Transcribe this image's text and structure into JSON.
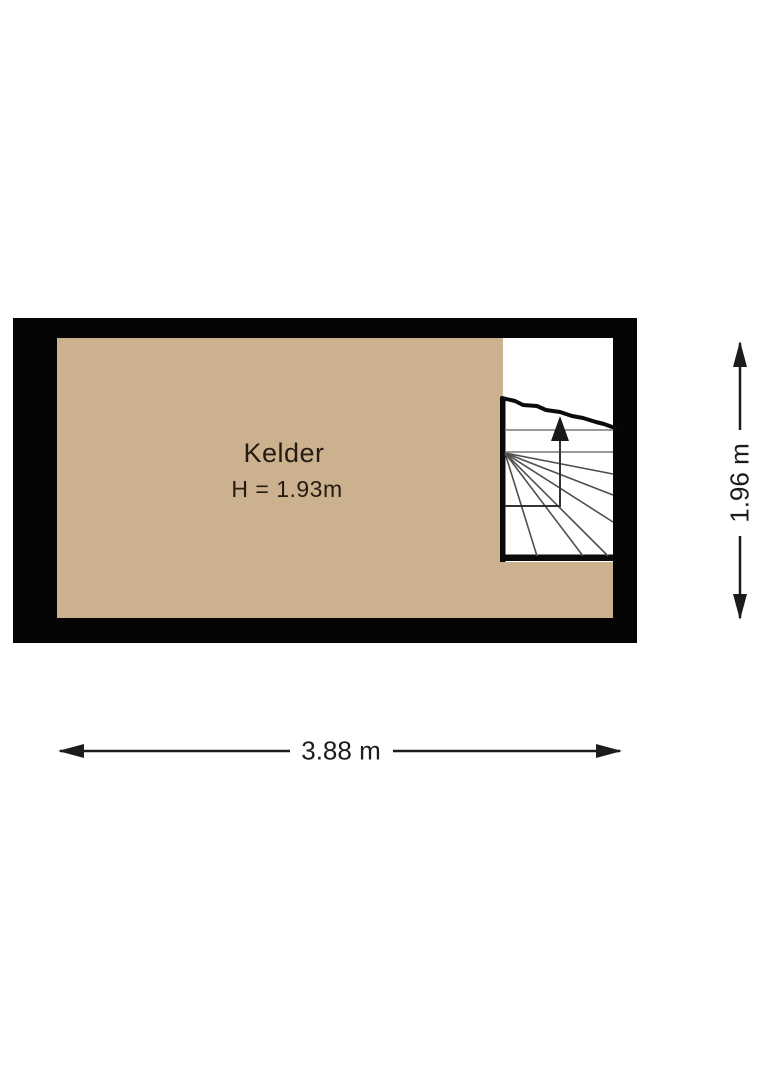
{
  "floor_plan": {
    "room": {
      "name": "Kelder",
      "ceiling_height_label": "H = 1.93m"
    },
    "dimensions": {
      "width_label": "3.88 m",
      "height_label": "1.96 m"
    },
    "stairs": {
      "ascend_direction": "up"
    },
    "colors": {
      "background": "#ffffff",
      "floor": "#cbb18e",
      "wall": "#050505",
      "stairwell": "#ffffff",
      "tread_line": "#999999",
      "winder_line": "#4f4f4f",
      "dimension_line": "#1c1c1c",
      "room_text": "#241b12"
    }
  }
}
